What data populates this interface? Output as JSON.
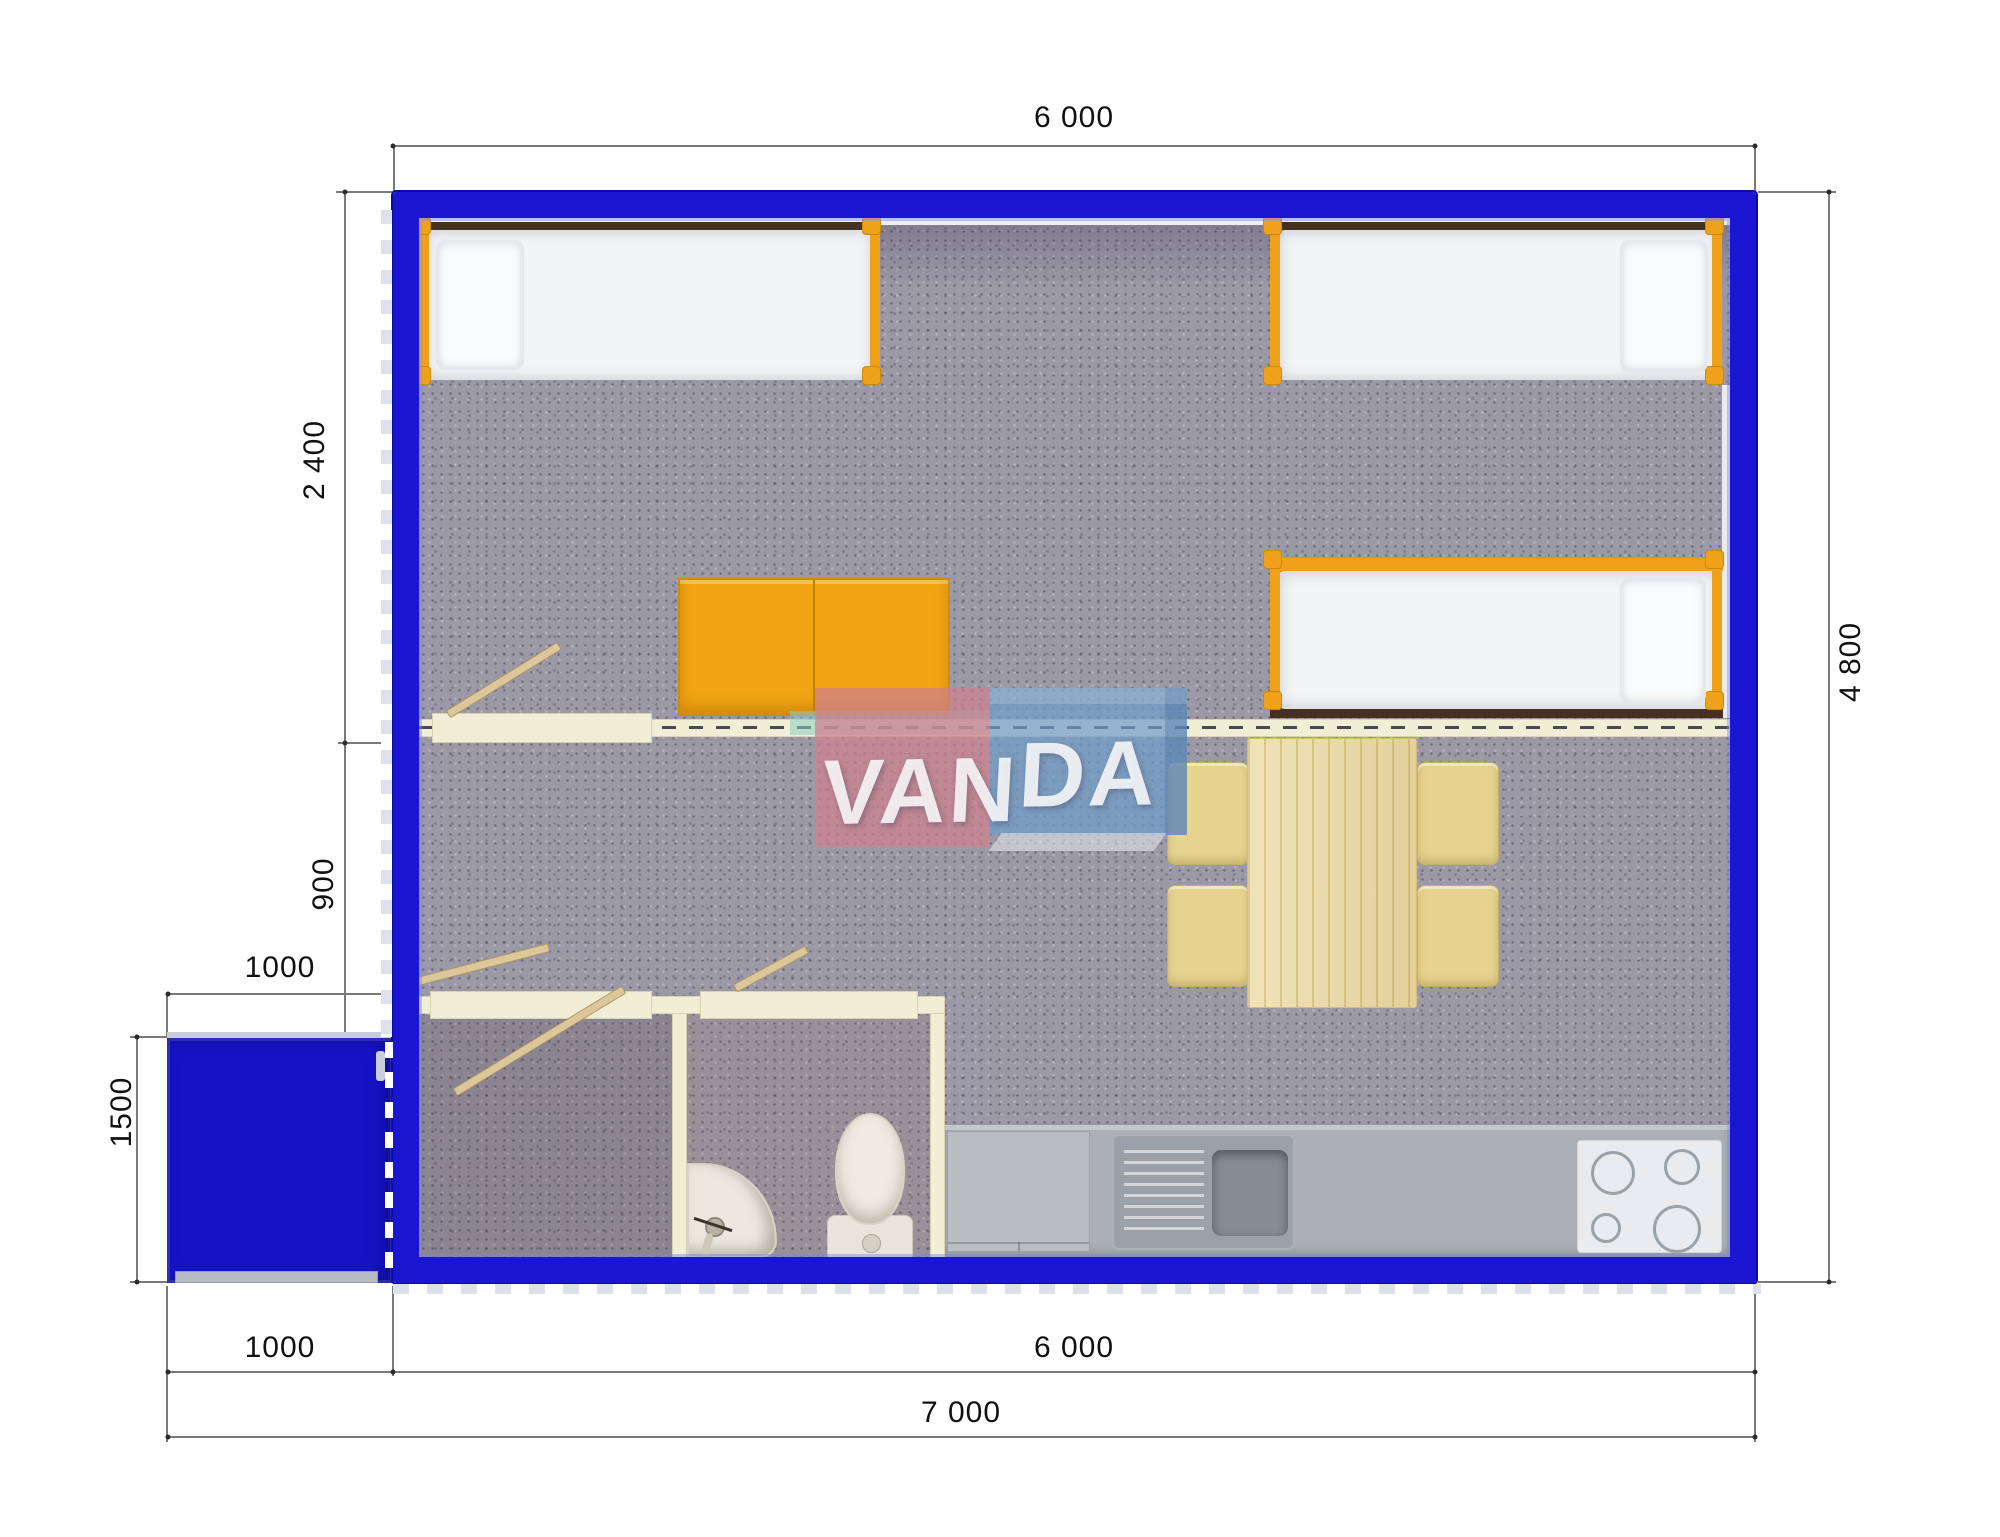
{
  "watermark": {
    "full": "VANDA",
    "text_van": "VAN",
    "text_da": "DA"
  },
  "dimensions": {
    "top_width": "6 000",
    "right_height": "4 800",
    "left_upper": "2 400",
    "left_middle": "900",
    "porch_width": "1000",
    "porch_height": "1500",
    "bottom_left": "1000",
    "bottom_main": "6 000",
    "bottom_total": "7 000"
  },
  "colors": {
    "wall_blue": "#1a16d2",
    "porch_blue": "#1613c6",
    "furniture_orange": "#f0a11b",
    "partition_cream": "#f2eed6",
    "carpet_gray": "#9c99a7",
    "counter_gray": "#abafb6",
    "table_wood": "#ecd9a1",
    "chair_yellow": "#e6d38f",
    "logo_pink": "#ce808e",
    "logo_blue": "#709cc9",
    "logo_teal": "#8ccdc3",
    "dimension_line": "#7a7a7a"
  }
}
